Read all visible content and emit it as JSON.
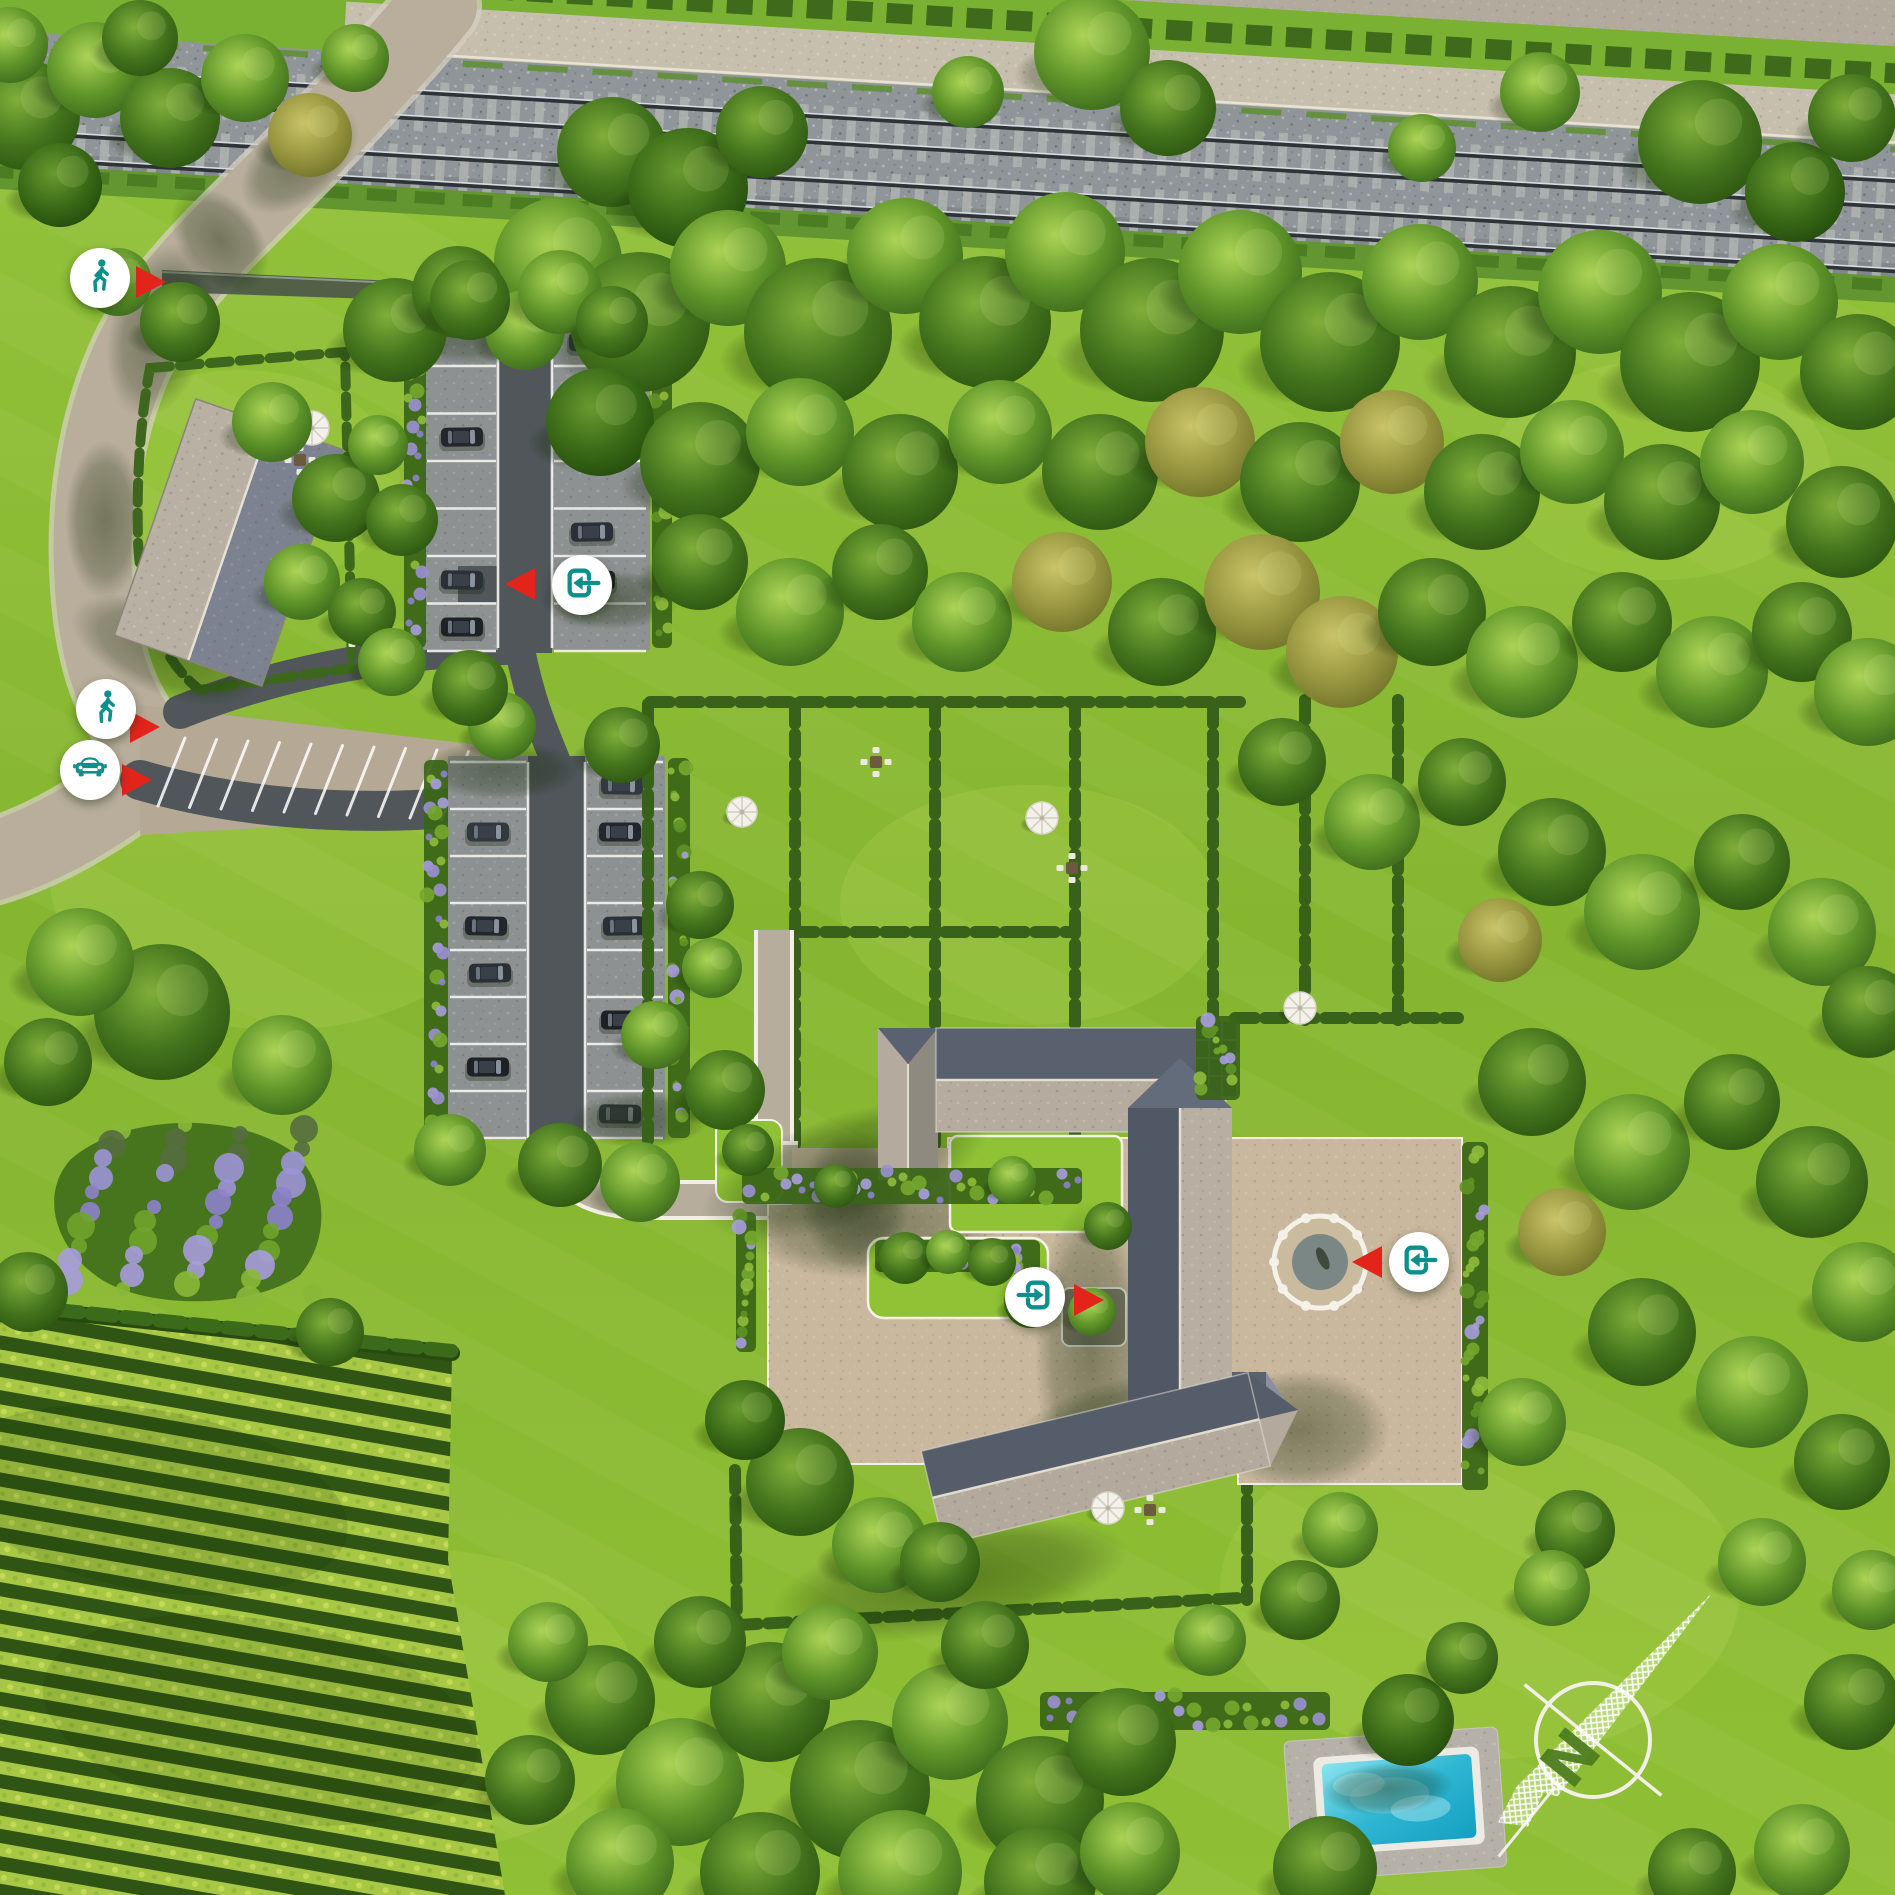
{
  "palette": {
    "accent_teal": "#0D8F8B",
    "pointer_red": "#E3241B",
    "marker_background": "#FFFFFF",
    "lawn_green": "#8ABB31",
    "forest_green": "#3E6C1B",
    "road_tan": "#B7AC9A",
    "asphalt_dark": "#50565A",
    "roof_dark": "#59606E",
    "roof_light": "#B5AC9F",
    "rail_ballast": "#8F9598",
    "pool_water": "#35BED8",
    "vineyard_row": "#A6C743"
  },
  "markers": [
    {
      "id": "pedestrian-access-north",
      "kind": "pedestrian access",
      "icon": "pedestrian-icon",
      "x": 100,
      "y": 278,
      "pointer": {
        "direction": "right",
        "x": 136,
        "y": 282
      }
    },
    {
      "id": "pedestrian-access-west",
      "kind": "pedestrian access",
      "icon": "pedestrian-icon",
      "x": 106,
      "y": 709,
      "pointer": {
        "direction": "right",
        "x": 130,
        "y": 727
      }
    },
    {
      "id": "vehicle-access-west",
      "kind": "vehicle access",
      "icon": "car-icon",
      "x": 90,
      "y": 770,
      "pointer": {
        "direction": "right",
        "x": 122,
        "y": 780
      }
    },
    {
      "id": "entrance-parking",
      "kind": "entrance",
      "icon": "enter-left-icon",
      "x": 582,
      "y": 585,
      "pointer": {
        "direction": "left",
        "x": 505,
        "y": 584
      }
    },
    {
      "id": "entrance-courtyard",
      "kind": "entrance",
      "icon": "enter-right-icon",
      "x": 1035,
      "y": 1297,
      "pointer": {
        "direction": "right",
        "x": 1074,
        "y": 1300
      }
    },
    {
      "id": "entrance-east-terrace",
      "kind": "entrance",
      "icon": "enter-left-icon",
      "x": 1419,
      "y": 1262,
      "pointer": {
        "direction": "left",
        "x": 1352,
        "y": 1262
      }
    }
  ],
  "compass": {
    "label": "N",
    "x": 1593,
    "y": 1740,
    "bearing_deg": 39
  }
}
